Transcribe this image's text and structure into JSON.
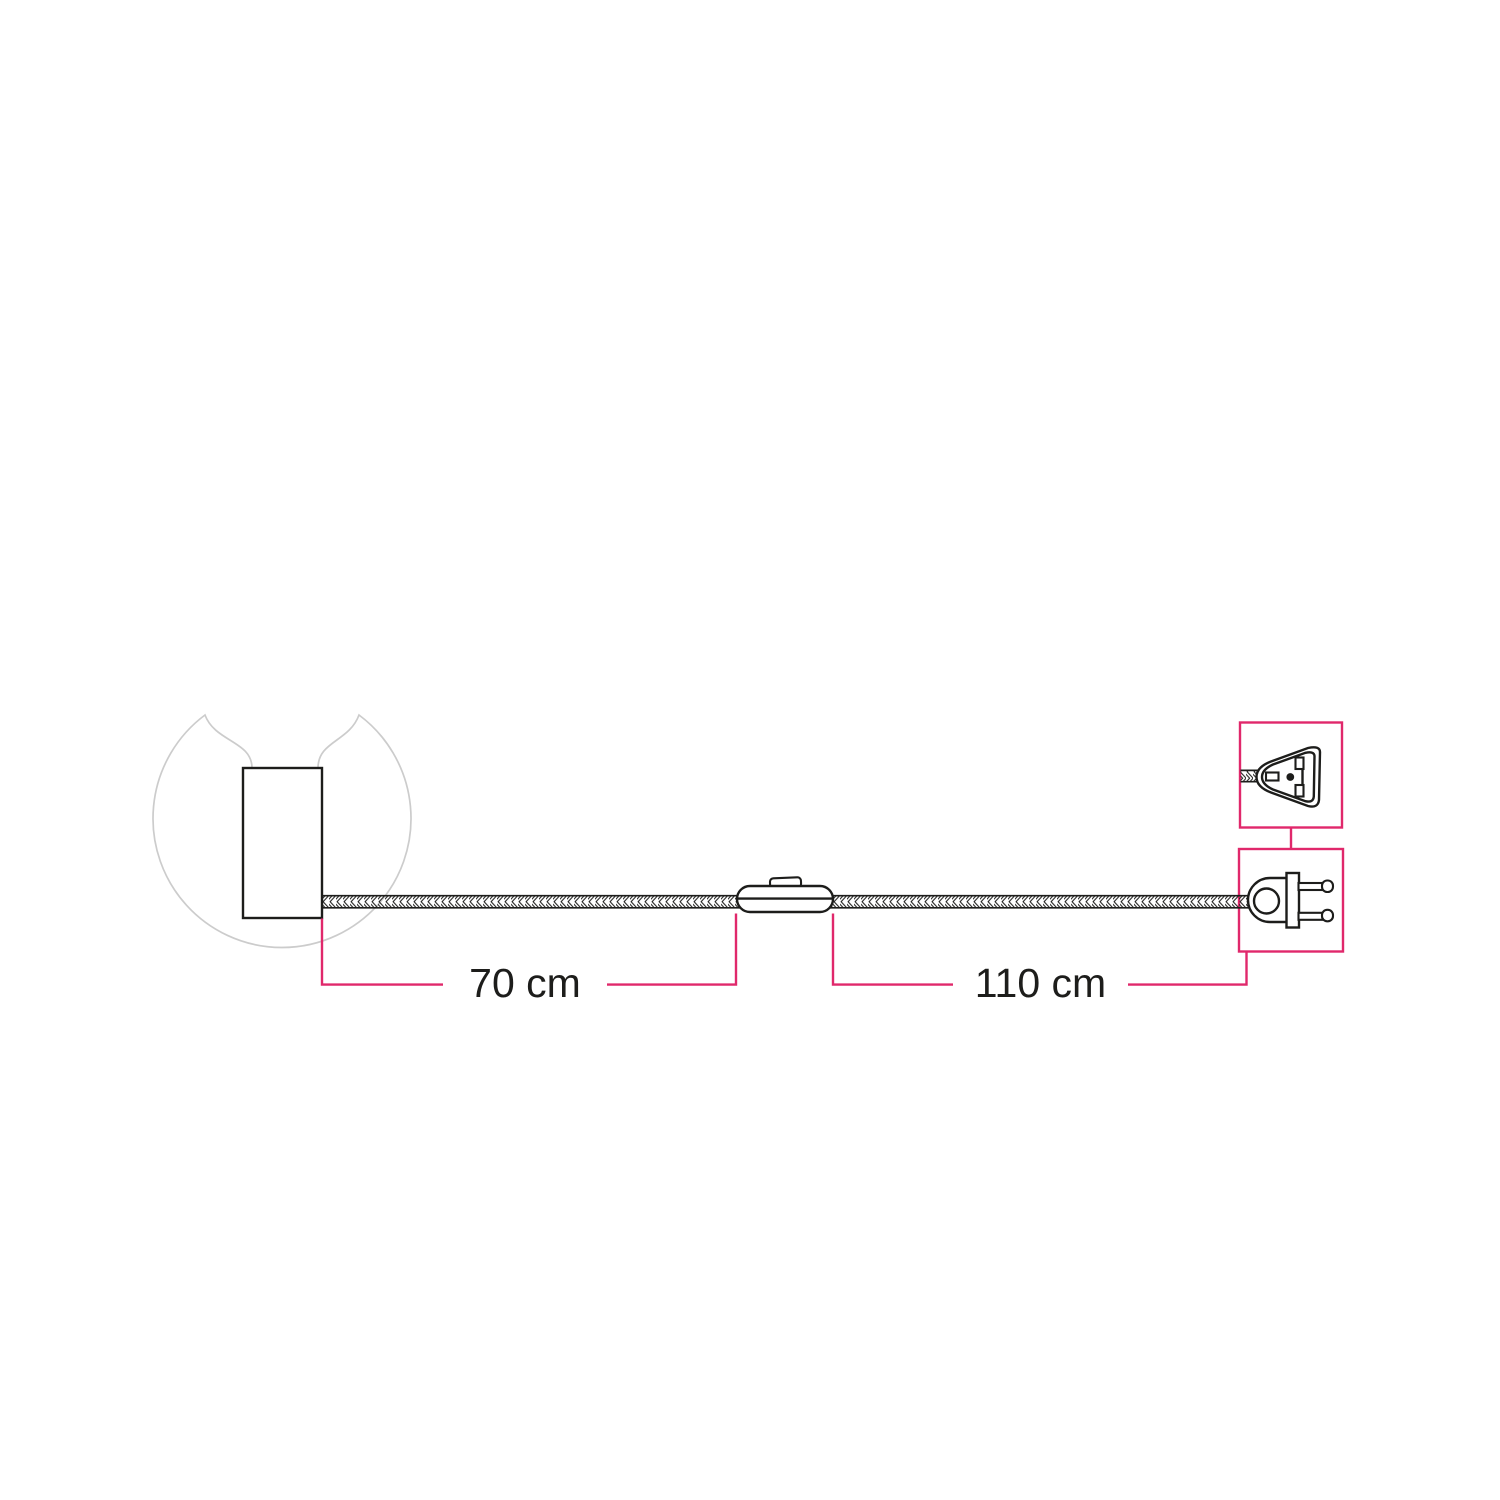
{
  "canvas": {
    "width": 1500,
    "height": 1500,
    "background": "#ffffff"
  },
  "colors": {
    "accent_pink": "#e0286b",
    "ink": "#1d1d1b",
    "bulb_outline_gray": "#cccccc"
  },
  "components": {
    "bulb": "globe-light-bulb",
    "lamp_holder": "cylindrical-lamp-holder",
    "cable": "braided-textile-cable",
    "switch": "inline-switch",
    "plug_front_view": "two-pin-plug-front-view",
    "plug_side_view": "two-pin-plug-side-view"
  },
  "dimensions": [
    {
      "id": "holder-to-switch",
      "label": "70 cm",
      "value": 70,
      "unit": "cm"
    },
    {
      "id": "switch-to-plug",
      "label": "110 cm",
      "value": 110,
      "unit": "cm"
    }
  ]
}
